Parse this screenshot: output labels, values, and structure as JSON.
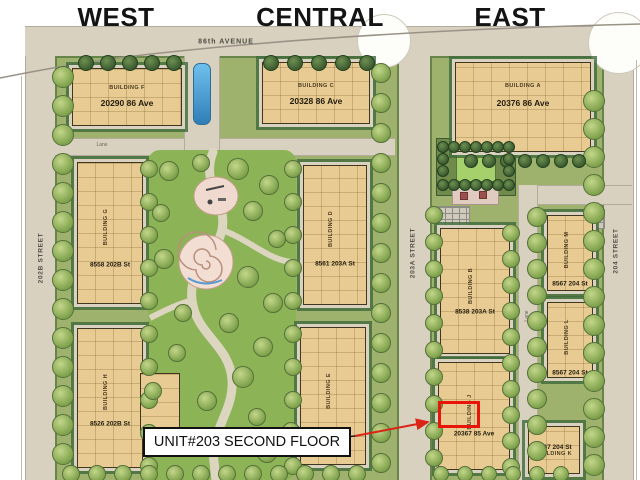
{
  "title_sections": {
    "west": "WEST",
    "central": "CENTRAL",
    "east": "EAST"
  },
  "streets": {
    "avenue_86": "86th AVENUE",
    "street_202b": "202B STREET",
    "street_203a": "203A STREET",
    "street_204": "204 STREET",
    "lane": "Lane"
  },
  "buildings": [
    {
      "id": "f",
      "name": "BUILDING F",
      "address": "20290 86 Ave"
    },
    {
      "id": "c",
      "name": "BUILDING C",
      "address": "20328 86 Ave"
    },
    {
      "id": "a",
      "name": "BUILDING A",
      "address": "20376 86 Ave"
    },
    {
      "id": "g",
      "name": "BUILDING G",
      "address": "8558 202B St"
    },
    {
      "id": "d",
      "name": "BUILDING D",
      "address": "8561 203A St"
    },
    {
      "id": "b",
      "name": "BUILDING B",
      "address": "8538 203A St"
    },
    {
      "id": "m",
      "name": "BUILDING M",
      "address": "8567 204 St"
    },
    {
      "id": "l",
      "name": "BUILDING L",
      "address": "8567 204 St"
    },
    {
      "id": "h",
      "name": "BUILDING H",
      "address": "8526 202B St"
    },
    {
      "id": "e",
      "name": "BUILDING E",
      "address": ""
    },
    {
      "id": "j",
      "name": "BUILDING J",
      "address": "20367 85 Ave"
    },
    {
      "id": "k",
      "name": "BUILDING K",
      "address": "8567 204 St"
    }
  ],
  "annotation": {
    "unit_label": "UNIT#203 SECOND FLOOR",
    "highlight_color": "#e8150b"
  },
  "colors": {
    "building_fill": "#e7cb92",
    "street_fill": "#d8d1c0",
    "block_green": "#9eb26d",
    "park_green": "#8cb356",
    "annotation_red": "#e8150b"
  }
}
